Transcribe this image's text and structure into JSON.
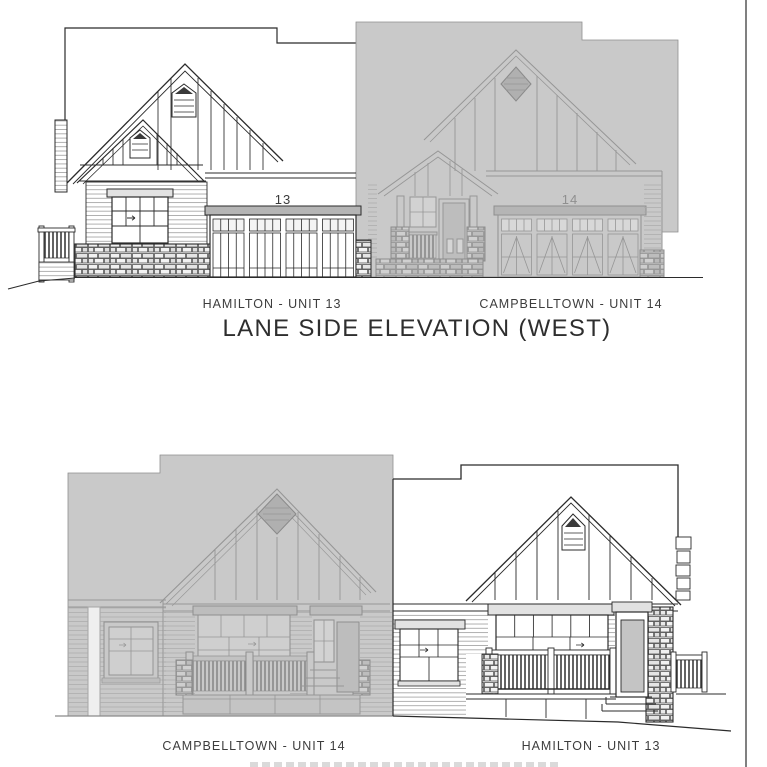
{
  "page": {
    "background": "#ffffff",
    "right_border_color": "#4a4a4a"
  },
  "top_elevation": {
    "title": "LANE SIDE ELEVATION (WEST)",
    "left_unit": {
      "label": "HAMILTON - UNIT 13",
      "garage_number": "13"
    },
    "right_unit": {
      "label": "CAMPBELLTOWN - UNIT 14",
      "garage_number": "14"
    }
  },
  "bottom_elevation": {
    "left_unit": {
      "label": "CAMPBELLTOWN - UNIT 14"
    },
    "right_unit": {
      "label": "HAMILTON - UNIT 13"
    }
  },
  "colors": {
    "dark_linework": "#2b2b2b",
    "gray_linework": "#969696",
    "gray_silhouette_fill": "#c9c9c9",
    "header_band_fill": "#b5b5b5",
    "vent_fill": "#b0b0b0"
  }
}
